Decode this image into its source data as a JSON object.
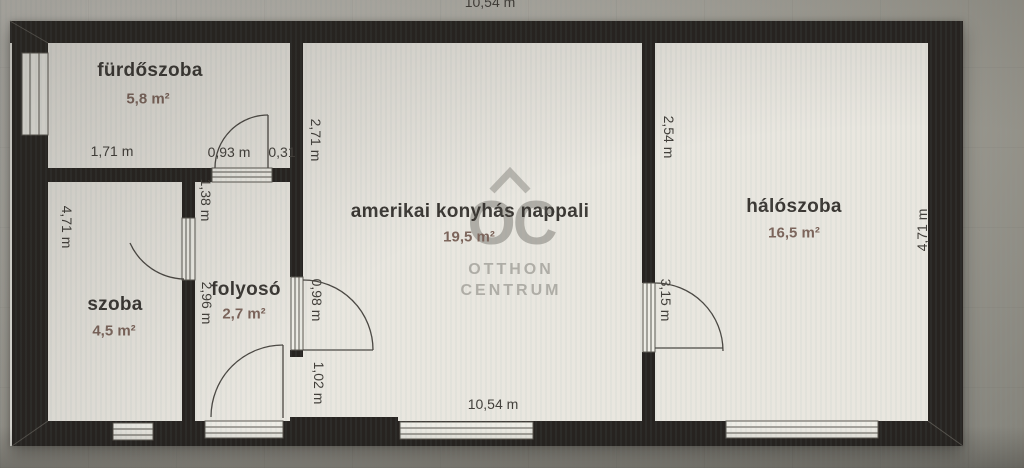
{
  "watermark": {
    "logo": "OC",
    "line1": "OTTHON",
    "line2": "CENTRUM"
  },
  "rooms": {
    "furdoszoba": {
      "name": "fürdőszoba",
      "area": "5,8 m²"
    },
    "szoba": {
      "name": "szoba",
      "area": "4,5 m²"
    },
    "folyoso": {
      "name": "folyosó",
      "area": "2,7 m²"
    },
    "nappali": {
      "name": "amerikai konyhás nappali",
      "area": "19,5 m²"
    },
    "haloszoba": {
      "name": "hálószoba",
      "area": "16,5 m²"
    }
  },
  "dimensions": {
    "top_total": "10,54 m",
    "furdoszoba_width": "1,71 m",
    "furdoszoba_door": "0,93 m",
    "furdoszoba_wall_stub": "0,31",
    "nappali_upper_left": "2,71 m",
    "folyoso_top": "1,38 m",
    "left_side": "4,71 m",
    "folyoso_left": "2,96 m",
    "folyoso_door_upper": "0,98 m",
    "folyoso_door_lower": "1,02 m",
    "bottom_total": "10,54 m",
    "haloszoba_upper": "2,54 m",
    "haloszoba_door": "3,15 m",
    "right_side": "4,71 m"
  },
  "colors": {
    "wall": "#272320",
    "floor": "#e9e6df",
    "window_fill": "#efede6",
    "frame_line": "#5a564f",
    "door_line": "#4a4641",
    "watermark": "#a3a099",
    "room_text": "#3a3632",
    "area_text": "#7c645a",
    "dim_text": "#413d38"
  }
}
